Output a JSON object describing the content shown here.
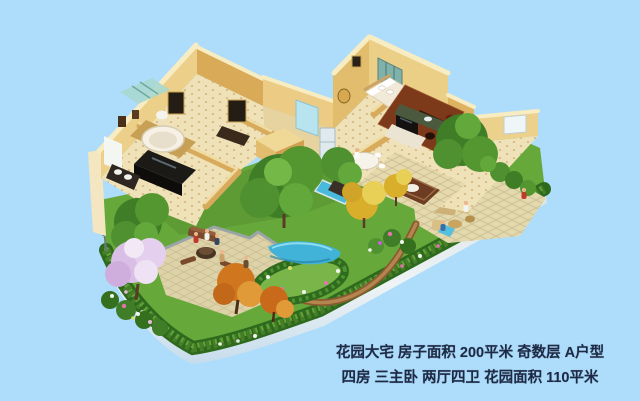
{
  "meta": {
    "width": 640,
    "height": 401,
    "kind": "real-estate 3D garden floor-plan render"
  },
  "caption": {
    "line1": "花园大宅 房子面积 200平米 奇数层 A户型",
    "line2": "四房 三主卧 两厅四卫 花园面积 110平米",
    "text_color": "#1d2a45"
  },
  "palette": {
    "sky": "#aeddfb",
    "wall_light": "#f2dfa6",
    "wall_mid": "#e9c87e",
    "wall_dark": "#cf9f4f",
    "floor": "#f0e2b8",
    "wood_floor": "#7c3a1a",
    "lawn": "#67a83b",
    "hedge": "#2e6a1d",
    "water": "#41b2d8",
    "stone_patio": "#ded3a8",
    "retaining_wall": "#e7edef",
    "blossom_tree": "#d9bfe6",
    "autumn_tree": "#d0761f",
    "golden_tree": "#d9ae2a",
    "foliage": "#54962f"
  },
  "scene": {
    "type": "isometric-cutaway-villa-with-garden",
    "elements": [
      "villa-cutaway-interior",
      "bathroom-shower",
      "round-bathtub",
      "bedroom-bed",
      "teal-wardrobe",
      "wood-study-floor",
      "tv-unit",
      "fridge",
      "dining-set",
      "garden-lawn",
      "boundary-hedge",
      "retaining-wall",
      "stone-patio-left",
      "stone-patio-right",
      "pond",
      "lap-pool",
      "blossom-tree",
      "autumn-trees",
      "golden-trees",
      "green-trees",
      "flower-beds",
      "tiny-people"
    ]
  }
}
